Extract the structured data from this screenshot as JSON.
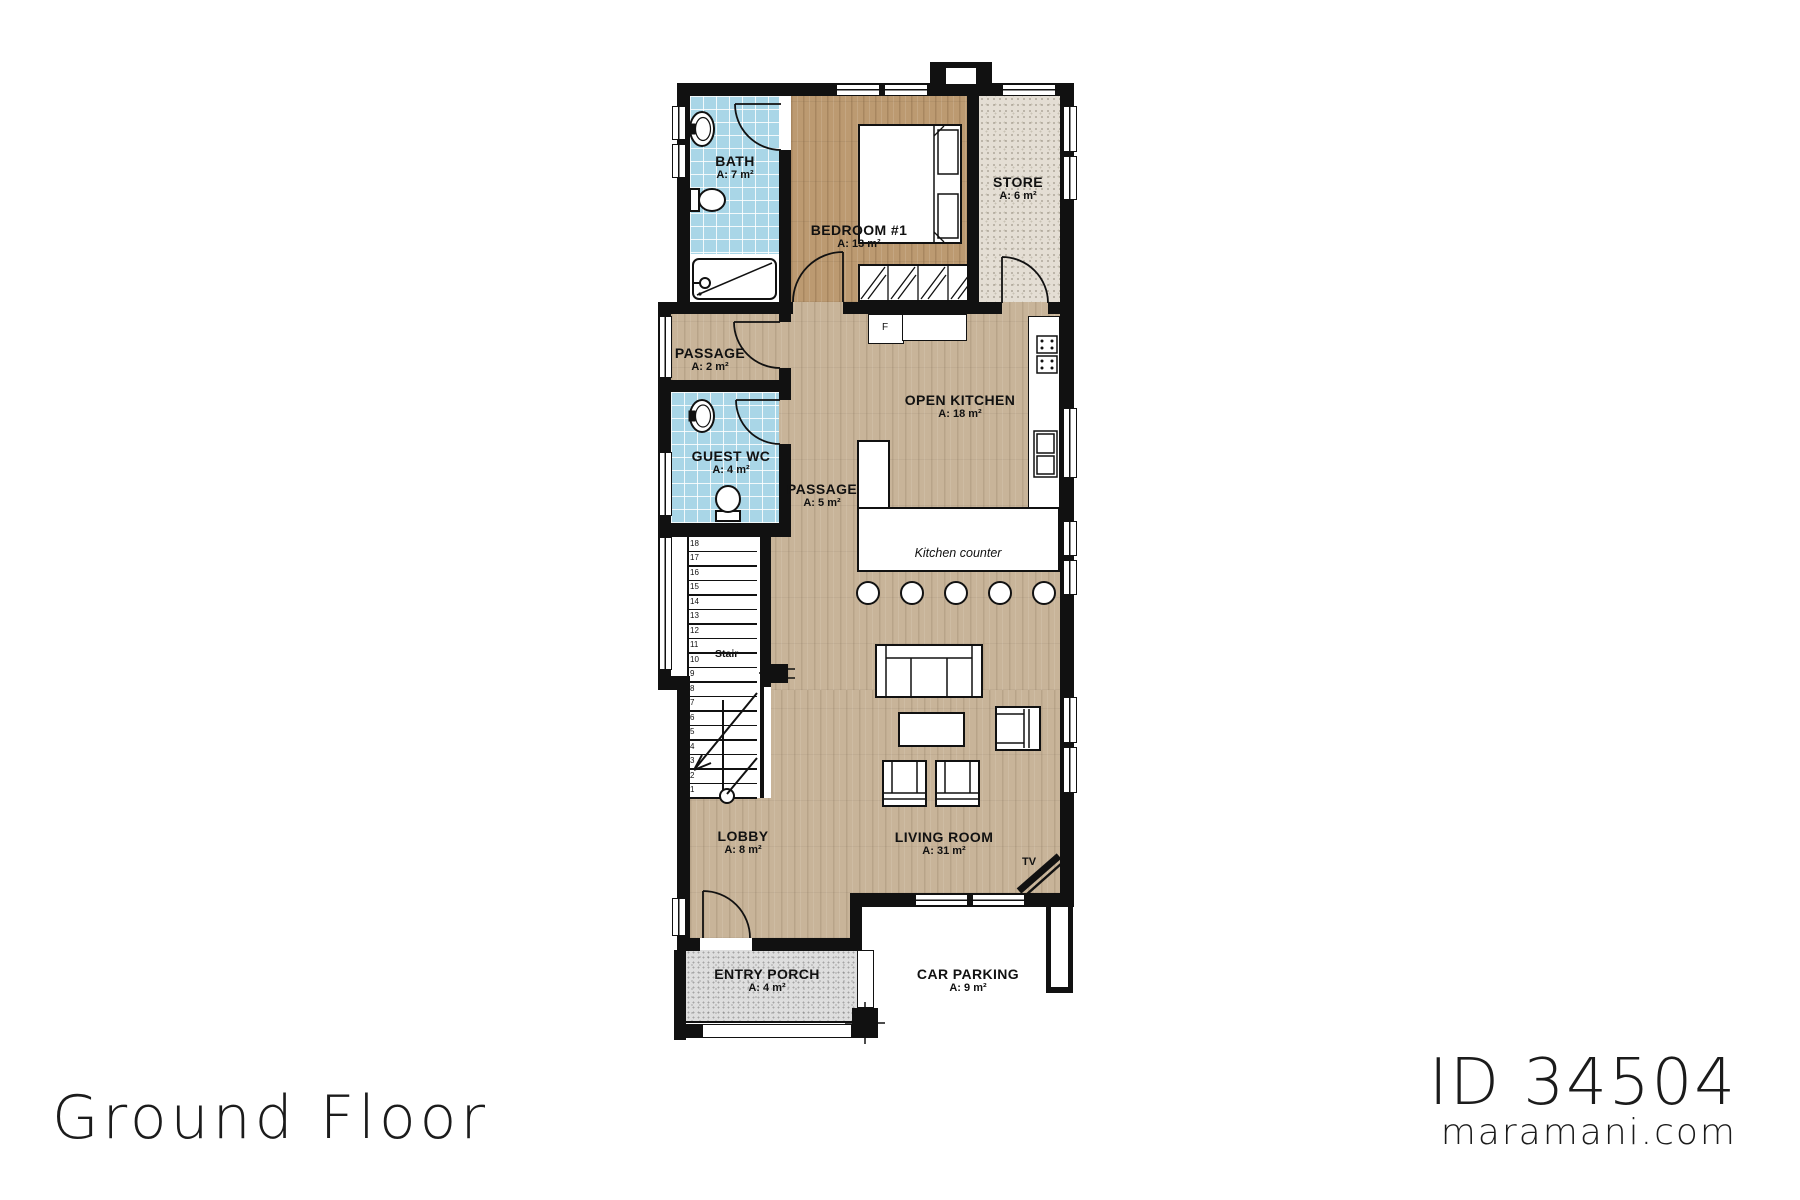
{
  "footer": {
    "floor_label": "Ground Floor",
    "plan_id": "ID 34504",
    "website": "maramani.com"
  },
  "rooms": {
    "bath": {
      "name": "BATH",
      "area": "A: 7 m²"
    },
    "bedroom1": {
      "name": "BEDROOM #1",
      "area": "A: 13 m²"
    },
    "store": {
      "name": "STORE",
      "area": "A: 6 m²"
    },
    "passage_upper": {
      "name": "PASSAGE",
      "area": "A: 2 m²"
    },
    "guest_wc": {
      "name": "GUEST WC",
      "area": "A: 4 m²"
    },
    "open_kitchen": {
      "name": "OPEN KITCHEN",
      "area": "A: 18 m²"
    },
    "passage_main": {
      "name": "PASSAGE",
      "area": "A: 5 m²"
    },
    "lobby": {
      "name": "LOBBY",
      "area": "A: 8 m²"
    },
    "living_room": {
      "name": "LIVING ROOM",
      "area": "A: 31 m²"
    },
    "entry_porch": {
      "name": "ENTRY PORCH",
      "area": "A: 4 m²"
    },
    "car_parking": {
      "name": "CAR PARKING",
      "area": "A: 9 m²"
    }
  },
  "annotations": {
    "stair": "Stair",
    "kitchen_counter": "Kitchen counter",
    "tv": "TV",
    "fridge": "F"
  },
  "stairs": {
    "numbers": [
      1,
      2,
      3,
      4,
      5,
      6,
      7,
      8,
      9,
      10,
      11,
      12,
      13,
      14,
      15,
      16,
      17,
      18
    ]
  },
  "colors": {
    "wall": "#111111",
    "tile_blue": "#a9d6e7",
    "wood_light": "#c8b499",
    "wood_bedroom": "#bc9a71",
    "store_floor": "#e4ded4",
    "porch_floor": "#dedede"
  }
}
